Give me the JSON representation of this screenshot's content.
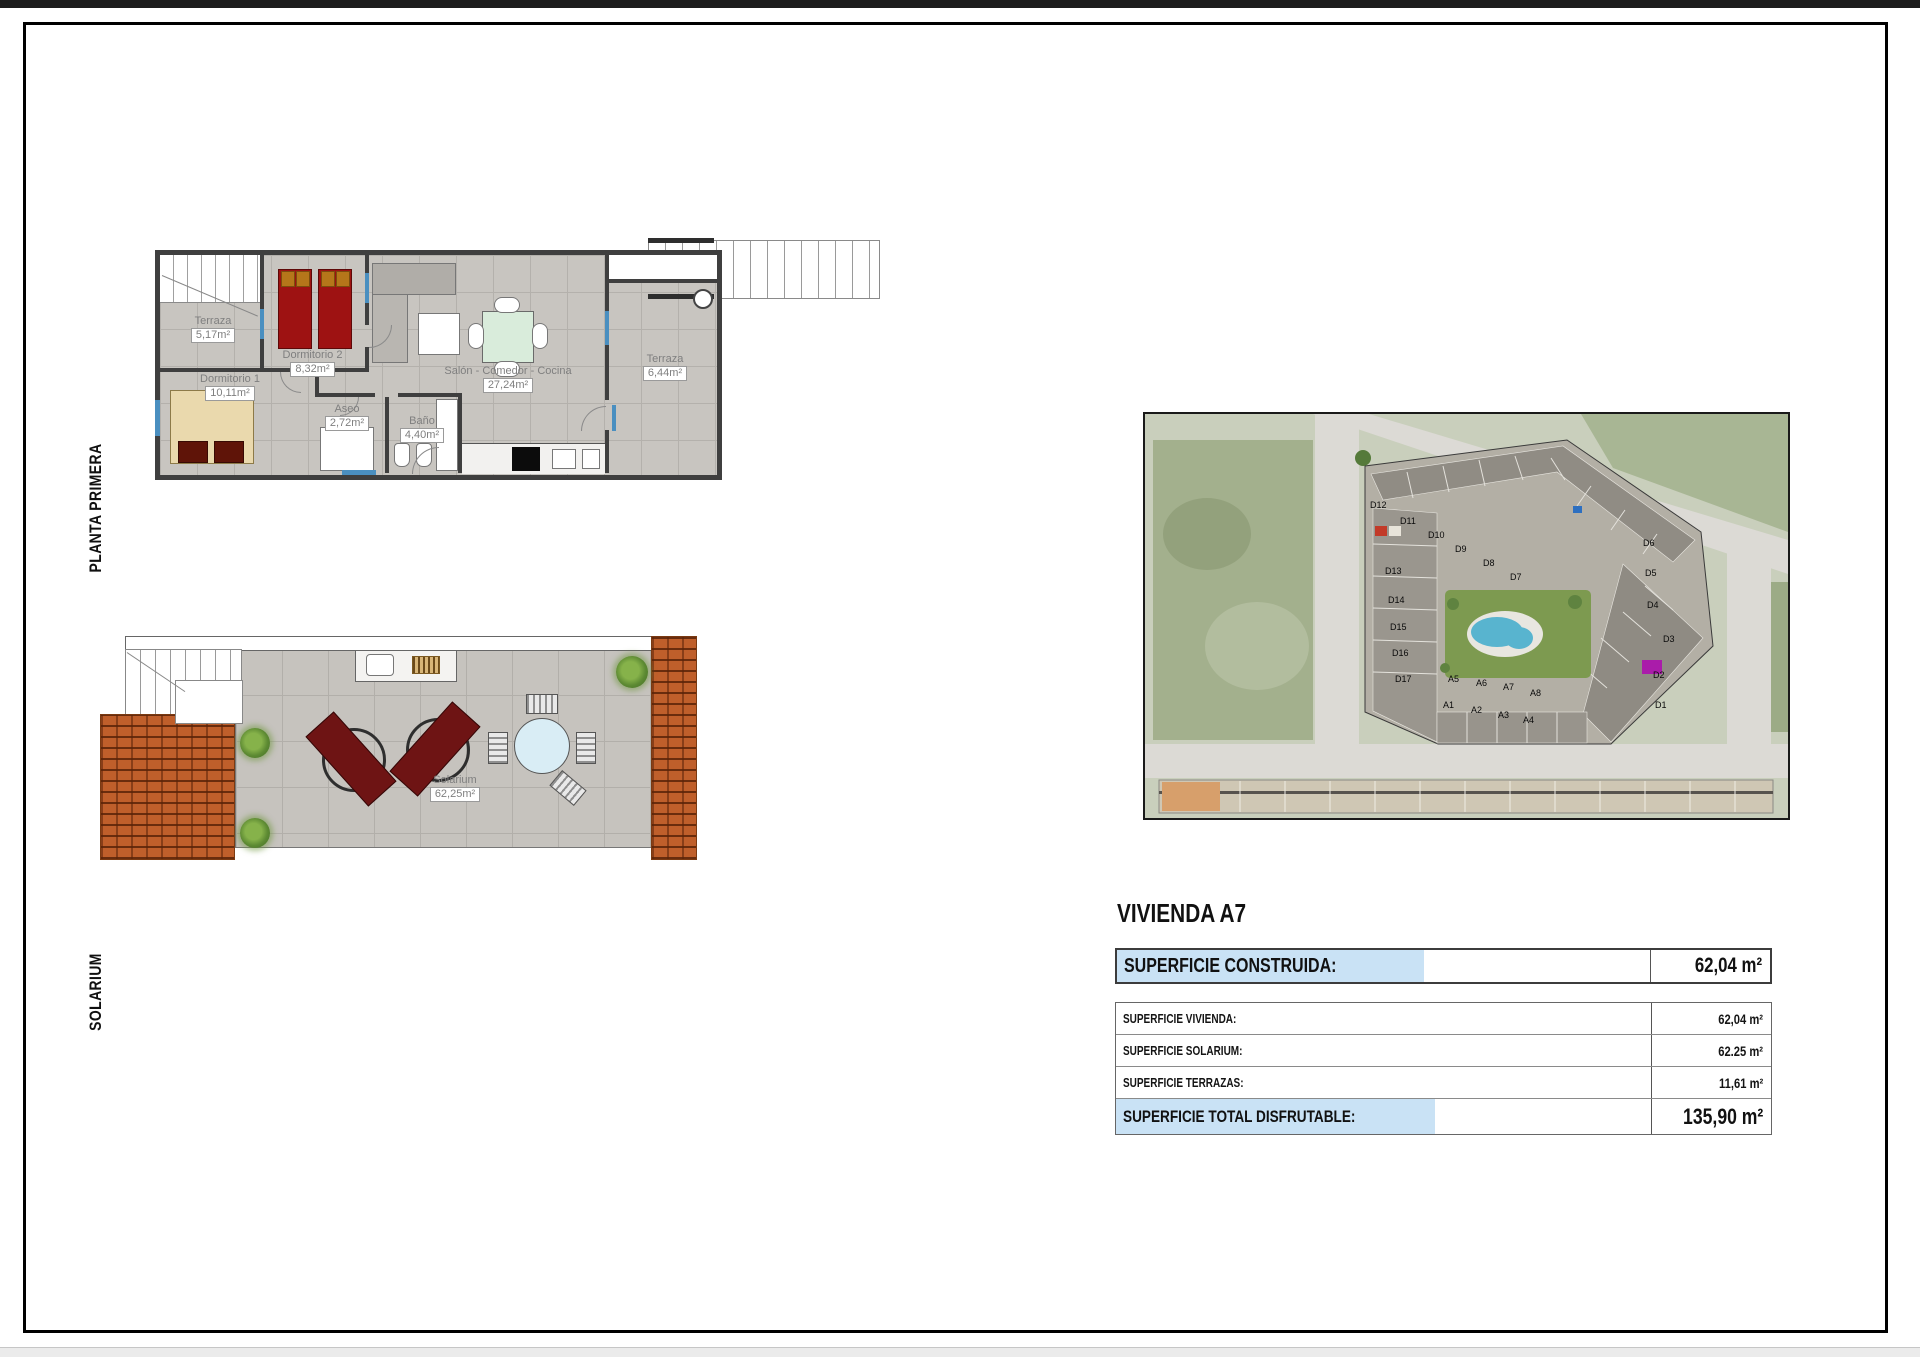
{
  "sidebar": {
    "planta_primera": "PLANTA PRIMERA",
    "solarium": "SOLARIUM"
  },
  "planta_primera": {
    "rooms": {
      "terraza1": {
        "name": "Terraza",
        "area": "5,17m²"
      },
      "dormitorio2": {
        "name": "Dormitorio 2",
        "area": "8,32m²"
      },
      "dormitorio1": {
        "name": "Dormitorio 1",
        "area": "10,11m²"
      },
      "aseo": {
        "name": "Aseo",
        "area": "2,72m²"
      },
      "bano": {
        "name": "Baño",
        "area": "4,40m²"
      },
      "salon": {
        "name": "Salón - Comedor - Cocina",
        "area": "27,24m²"
      },
      "terraza2": {
        "name": "Terraza",
        "area": "6,44m²"
      }
    }
  },
  "solarium_plan": {
    "room": {
      "name": "Solarium",
      "area": "62,25m²"
    }
  },
  "site_map": {
    "units": [
      "D12",
      "D11",
      "D10",
      "D9",
      "D8",
      "D7",
      "D13",
      "D14",
      "D15",
      "D16",
      "D17",
      "D6",
      "D5",
      "D4",
      "D3",
      "D2",
      "D1",
      "A5",
      "A6",
      "A7",
      "A8",
      "A1",
      "A2",
      "A3",
      "A4"
    ]
  },
  "summary": {
    "title": "VIVIENDA A7",
    "construida": {
      "label": "SUPERFICIE CONSTRUIDA:",
      "value": "62,04 m²"
    },
    "rows": [
      {
        "label": "SUPERFICIE VIVIENDA:",
        "value": "62,04 m²"
      },
      {
        "label": "SUPERFICIE SOLARIUM:",
        "value": "62.25 m²"
      },
      {
        "label": "SUPERFICIE TERRAZAS:",
        "value": "11,61 m²"
      }
    ],
    "total": {
      "label": "SUPERFICIE TOTAL DISFRUTABLE:",
      "value": "135,90 m²"
    }
  },
  "colors": {
    "highlight_blue": "#c9e2f5",
    "wall": "#3f3f3f",
    "tile": "#c8c5c0",
    "bed_red": "#9e1212",
    "brick": "#bf5f2b",
    "pool": "#58b4cf",
    "lawn": "#7d9a50",
    "unit_highlight": "#aa1caa"
  }
}
